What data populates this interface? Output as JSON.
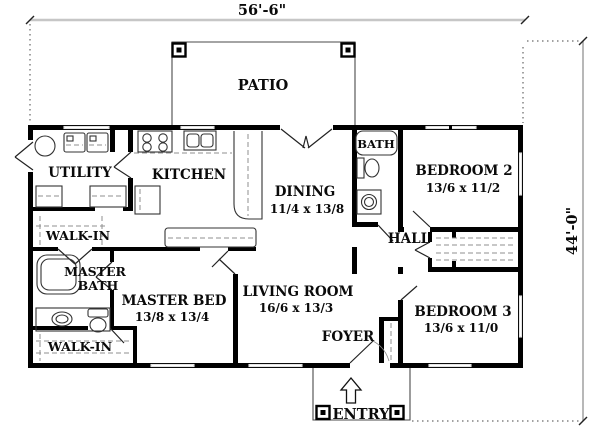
{
  "plan": {
    "dim_width": "56'-6\"",
    "dim_height": "44'-0\"",
    "outdoor": {
      "patio": "PATIO",
      "entry": "ENTRY"
    },
    "rooms": {
      "utility": {
        "label": "UTILITY"
      },
      "kitchen": {
        "label": "KITCHEN"
      },
      "dining": {
        "label": "DINING",
        "size": "11/4 x 13/8"
      },
      "bath": {
        "label": "BATH"
      },
      "bedroom2": {
        "label": "BEDROOM 2",
        "size": "13/6 x 11/2"
      },
      "hall": {
        "label": "HALL"
      },
      "walkin_upper": {
        "label": "WALK-IN"
      },
      "master_bath": {
        "line1": "MASTER",
        "line2": "BATH"
      },
      "master_bed": {
        "label": "MASTER BED",
        "size": "13/8 x 13/4"
      },
      "living_room": {
        "label": "LIVING ROOM",
        "size": "16/6 x 13/3"
      },
      "foyer": {
        "label": "FOYER"
      },
      "walkin_lower": {
        "label": "WALK-IN"
      },
      "bedroom3": {
        "label": "BEDROOM 3",
        "size": "13/6 x 11/0"
      }
    },
    "colors": {
      "wall": "#000000",
      "dimension_line": "#c6c6c6",
      "background": "#ffffff"
    }
  }
}
